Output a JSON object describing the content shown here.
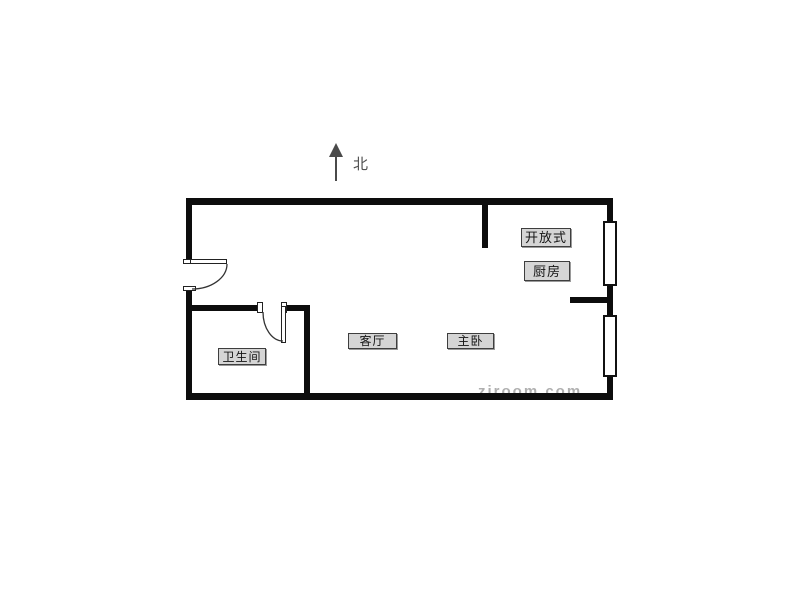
{
  "compass": {
    "label": "北"
  },
  "floorplan": {
    "rooms": {
      "kitchen": {
        "label_line1": "开放式",
        "label_line2": "厨房"
      },
      "bathroom": {
        "label": "卫生间"
      },
      "living": {
        "label": "客厅"
      },
      "bedroom": {
        "label": "主卧"
      }
    }
  },
  "watermark": {
    "text": "ziroom.com"
  },
  "colors": {
    "background": "#ffffff",
    "wall": "#0d0d0d",
    "label_background": "#d5d5d5",
    "label_border": "#3e3e3e",
    "label_text": "#151515",
    "compass": "#4a4a4a",
    "watermark": "#6f6f6f"
  }
}
